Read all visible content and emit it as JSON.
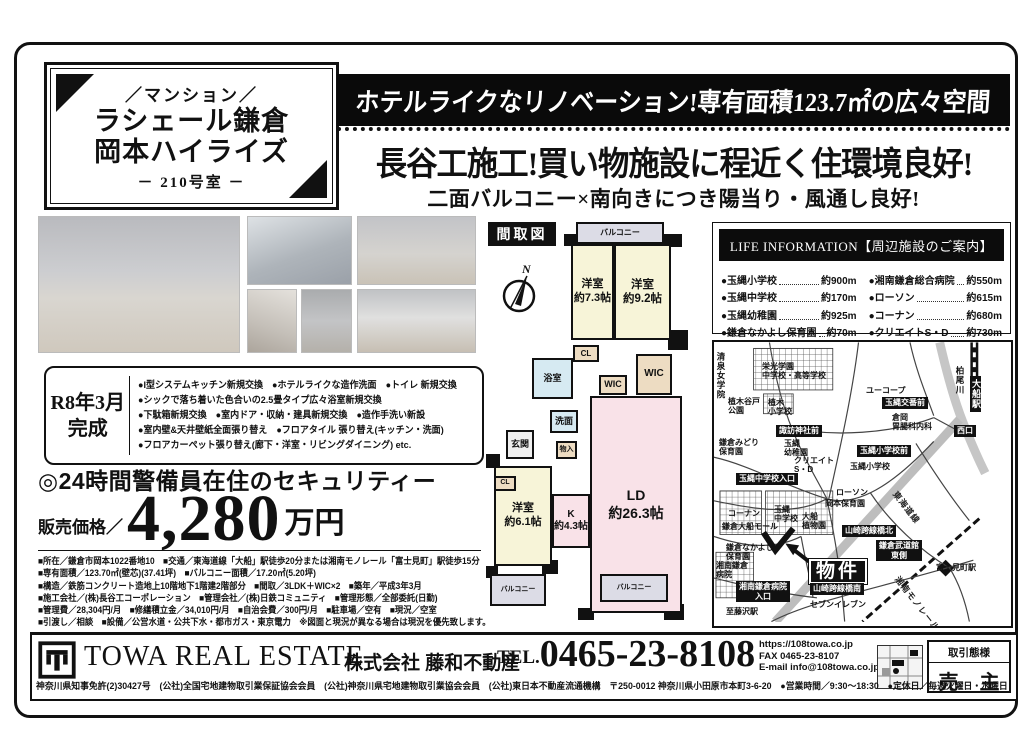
{
  "property_box": {
    "category": "／マンション／",
    "name_line1": "ラシェール鎌倉",
    "name_line2": "岡本ハイライズ",
    "room": "－ 210号室 －"
  },
  "headlines": {
    "banner": "ホテルライクなリノベーション!専有面積123.7㎡の広々空間",
    "main": "長谷工施工!買い物施設に程近く住環境良好!",
    "sub": "二面バルコニー×南向きにつき陽当り・風通し良好!"
  },
  "completion": {
    "line1": "R8年3月",
    "line2": "完成"
  },
  "renovation": {
    "items": [
      "●I型システムキッチン新規交換　●ホテルライクな造作洗面　●トイレ 新規交換",
      "●シックで落ち着いた色合いの2.5畳タイプ広々浴室新規交換",
      "●下駄箱新規交換　●室内ドア・収納・建具新規交換　●造作手洗い新設",
      "●室内壁&天井壁紙全面張り替え　●フロアタイル 張り替え(キッチン・洗面)",
      "●フロアカーペット張り替え(廊下・洋室・リビングダイニング) etc."
    ]
  },
  "security": "◎24時間警備員在住のセキュリティー",
  "price": {
    "label": "販売価格／",
    "amount": "4,280",
    "unit": "万円"
  },
  "details": [
    "■所在／鎌倉市岡本1022番地10　■交通／東海道線「大船」駅徒歩20分または湘南モノレール「富士見町」駅徒歩15分",
    "■専有面積／123.70㎡(壁芯)(37.41坪)　■バルコニー面積／17.20㎡(5.20坪)",
    "■構造／鉄筋コンクリート造地上10階地下1階建2階部分　■間取／3LDK＋WIC×2　■築年／平成3年3月",
    "■施工会社／(株)長谷工コーポレーション　■管理会社／(株)日鉄コミュニティ　■管理形態／全部委託(日勤)",
    "■管理費／28,304円/月　■修繕積立金／34,010円/月　■自治会費／300円/月　■駐車場／空有　■現況／空室",
    "■引渡し／相談　■設備／公営水道・公共下水・都市ガス・東京電力　※図面と現況が異なる場合は現況を優先致します。"
  ],
  "floorplan": {
    "title": "間取図",
    "compass_n": "N",
    "rooms": [
      {
        "label": "バルコニー",
        "x": 90,
        "y": 4,
        "w": 88,
        "h": 22,
        "cls": "balcony",
        "fs": 8
      },
      {
        "label": "洋室\n約7.3帖",
        "x": 85,
        "y": 26,
        "w": 43,
        "h": 96,
        "cls": "room",
        "fs": 11
      },
      {
        "label": "洋室\n約9.2帖",
        "x": 128,
        "y": 26,
        "w": 57,
        "h": 96,
        "cls": "room",
        "fs": 11.5
      },
      {
        "label": "CL",
        "x": 87,
        "y": 127,
        "w": 26,
        "h": 17,
        "cls": "closet",
        "fs": 8
      },
      {
        "label": "浴室",
        "x": 46,
        "y": 140,
        "w": 41,
        "h": 41,
        "cls": "bath",
        "fs": 9
      },
      {
        "label": "WIC",
        "x": 113,
        "y": 157,
        "w": 28,
        "h": 20,
        "cls": "closet",
        "fs": 9
      },
      {
        "label": "WIC",
        "x": 150,
        "y": 136,
        "w": 36,
        "h": 41,
        "cls": "closet",
        "fs": 10
      },
      {
        "label": "洗面",
        "x": 64,
        "y": 192,
        "w": 28,
        "h": 23,
        "cls": "bath",
        "fs": 9
      },
      {
        "label": "玄関",
        "x": 20,
        "y": 212,
        "w": 28,
        "h": 29,
        "cls": "hall",
        "fs": 9
      },
      {
        "label": "物入",
        "x": 70,
        "y": 223,
        "w": 21,
        "h": 18,
        "cls": "closet",
        "fs": 7
      },
      {
        "label": "LD\n約26.3帖",
        "x": 104,
        "y": 178,
        "w": 92,
        "h": 217,
        "cls": "ld",
        "fs": 14
      },
      {
        "label": "K\n約4.3帖",
        "x": 66,
        "y": 276,
        "w": 38,
        "h": 54,
        "cls": "ld",
        "fs": 10
      },
      {
        "label": "洋室\n約6.1帖",
        "x": 8,
        "y": 248,
        "w": 58,
        "h": 100,
        "cls": "room",
        "fs": 11
      },
      {
        "label": "CL",
        "x": 8,
        "y": 258,
        "w": 22,
        "h": 15,
        "cls": "closet",
        "fs": 7
      },
      {
        "label": "バルコニー",
        "x": 4,
        "y": 356,
        "w": 56,
        "h": 32,
        "cls": "balcony",
        "fs": 7
      },
      {
        "label": "バルコニー",
        "x": 114,
        "y": 356,
        "w": 68,
        "h": 28,
        "cls": "balcony",
        "fs": 7
      }
    ]
  },
  "life_information": {
    "title": "LIFE INFORMATION【周辺施設のご案内】",
    "items": [
      {
        "name": "玉縄小学校",
        "distance": "約900m"
      },
      {
        "name": "玉縄中学校",
        "distance": "約170m"
      },
      {
        "name": "玉縄幼稚園",
        "distance": "約925m"
      },
      {
        "name": "鎌倉なかよし保育園",
        "distance": "約70m"
      },
      {
        "name": "湘南鎌倉総合病院",
        "distance": "約550m"
      },
      {
        "name": "ローソン",
        "distance": "約615m"
      },
      {
        "name": "コーナン",
        "distance": "約680m"
      },
      {
        "name": "クリエイトS・D",
        "distance": "約730m"
      }
    ]
  },
  "map": {
    "labels": [
      {
        "t": "清泉女学院",
        "x": 2,
        "y": 10,
        "cls": "vert"
      },
      {
        "t": "栄光学園\n中学校・高等学校",
        "x": 48,
        "y": 20,
        "cls": "plain"
      },
      {
        "t": "植木谷戸\n公園",
        "x": 14,
        "y": 55,
        "cls": "plain"
      },
      {
        "t": "植木\n小学校",
        "x": 54,
        "y": 56,
        "cls": "plain"
      },
      {
        "t": "ユーコープ",
        "x": 152,
        "y": 44,
        "cls": "plain"
      },
      {
        "t": "玉縄交番前",
        "x": 168,
        "y": 55,
        "cls": "black"
      },
      {
        "t": "倉岡\n胃腸科内科",
        "x": 178,
        "y": 71,
        "cls": "plain"
      },
      {
        "t": "柏尾川",
        "x": 241,
        "y": 24,
        "cls": "vert"
      },
      {
        "t": "大船駅",
        "x": 256,
        "y": 34,
        "cls": "black-vert"
      },
      {
        "t": "西口",
        "x": 240,
        "y": 83,
        "cls": "black"
      },
      {
        "t": "諏訪神社前",
        "x": 62,
        "y": 83,
        "cls": "black"
      },
      {
        "t": "鎌倉みどり\n保育園",
        "x": 5,
        "y": 96,
        "cls": "plain"
      },
      {
        "t": "玉縄\n幼稚園",
        "x": 70,
        "y": 97,
        "cls": "plain"
      },
      {
        "t": "クリエイト\nS・D",
        "x": 80,
        "y": 114,
        "cls": "plain"
      },
      {
        "t": "玉縄小学校前",
        "x": 143,
        "y": 103,
        "cls": "black"
      },
      {
        "t": "玉縄小学校",
        "x": 136,
        "y": 120,
        "cls": "plain"
      },
      {
        "t": "玉縄中学校入口",
        "x": 22,
        "y": 131,
        "cls": "black"
      },
      {
        "t": "ローソン",
        "x": 122,
        "y": 146,
        "cls": "plain"
      },
      {
        "t": "岡本保育園",
        "x": 111,
        "y": 157,
        "cls": "plain"
      },
      {
        "t": "玉縄\n中学校",
        "x": 60,
        "y": 163,
        "cls": "plain"
      },
      {
        "t": "大船\n植物園",
        "x": 88,
        "y": 170,
        "cls": "plain"
      },
      {
        "t": "コーナン",
        "x": 14,
        "y": 167,
        "cls": "plain"
      },
      {
        "t": "鎌倉大船モール",
        "x": 8,
        "y": 180,
        "cls": "plain"
      },
      {
        "t": "山崎跨線橋北",
        "x": 128,
        "y": 183,
        "cls": "black"
      },
      {
        "t": "東海道線",
        "x": 184,
        "y": 148,
        "cls": "rot"
      },
      {
        "t": "鎌倉なかよし\n保育園",
        "x": 12,
        "y": 201,
        "cls": "plain"
      },
      {
        "t": "湘南鎌倉\n病院",
        "x": 2,
        "y": 219,
        "cls": "plain"
      },
      {
        "t": "湘南鎌倉病院\n入口",
        "x": 22,
        "y": 239,
        "cls": "black2"
      },
      {
        "t": "物件",
        "x": 94,
        "y": 216,
        "cls": "big"
      },
      {
        "t": "鎌倉武道館\n東側",
        "x": 162,
        "y": 198,
        "cls": "black2"
      },
      {
        "t": "富士見町駅",
        "x": 222,
        "y": 221,
        "cls": "plain"
      },
      {
        "t": "山崎跨線橋南",
        "x": 96,
        "y": 241,
        "cls": "black"
      },
      {
        "t": "セブンイレブン",
        "x": 96,
        "y": 258,
        "cls": "plain"
      },
      {
        "t": "至藤沢駅",
        "x": 12,
        "y": 265,
        "cls": "plain"
      },
      {
        "t": "湘南モノレール",
        "x": 186,
        "y": 233,
        "cls": "rot"
      }
    ]
  },
  "footer": {
    "company_en": "TOWA REAL ESTATE",
    "company_jp": "株式会社 藤和不動産",
    "tel_label": "TEL.",
    "tel_number": "0465-23-8108",
    "url": "https://108towa.co.jp",
    "fax": "FAX 0465-23-8107",
    "email": "E-mail info@108towa.co.jp",
    "dealer_title": "取引態様",
    "dealer_value": "売 主",
    "license": "神奈川県知事免許(2)30427号　(公社)全国宅地建物取引業保証協会会員　(公社)神奈川県宅地建物取引業協会会員　(公社)東日本不動産流通機構　〒250-0012 神奈川県小田原市本町3-6-20　●営業時間／9:30～18:30　●定休日／毎週火曜日・水曜日"
  }
}
